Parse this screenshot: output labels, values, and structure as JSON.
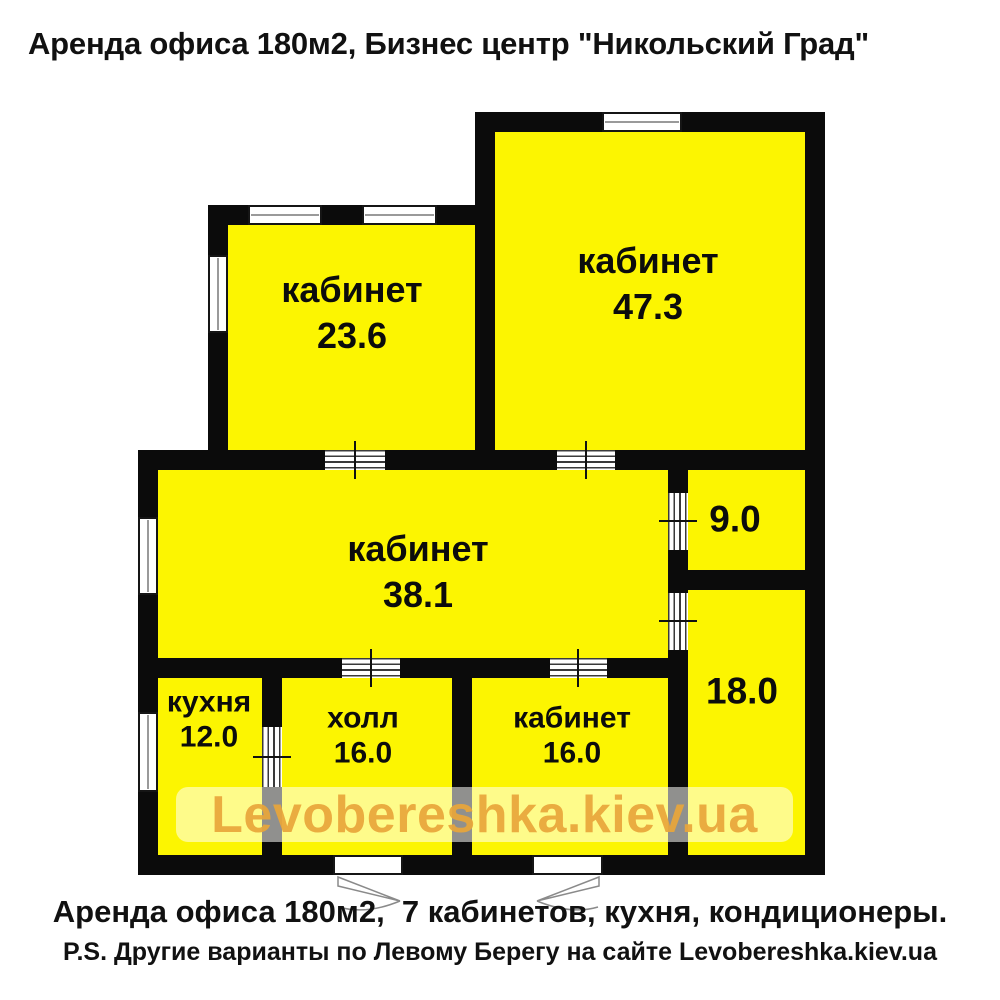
{
  "title": "Аренда офиса 180м2, Бизнес центр \"Никольский Град\"",
  "watermark": "Levobereshka.kiev.ua",
  "footer": {
    "line1": "Аренда офиса 180м2,  7 кабинетов, кухня, кондиционеры.",
    "line2": "P.S. Другие варианты по Левому Берегу на сайте Levobereshka.kiev.ua"
  },
  "rooms": [
    {
      "label": "кабинет",
      "area": "23.6"
    },
    {
      "label": "кабинет",
      "area": "47.3"
    },
    {
      "label": "кабинет",
      "area": "38.1"
    },
    {
      "label": "",
      "area": "9.0"
    },
    {
      "label": "",
      "area": "18.0"
    },
    {
      "label": "кухня",
      "area": "12.0"
    },
    {
      "label": "холл",
      "area": "16.0"
    },
    {
      "label": "кабинет",
      "area": "16.0"
    }
  ],
  "colors": {
    "room_fill": "#fcf501",
    "wall": "#0b0b0b",
    "watermark_text": "#e9a63a",
    "title_text": "#111111"
  }
}
